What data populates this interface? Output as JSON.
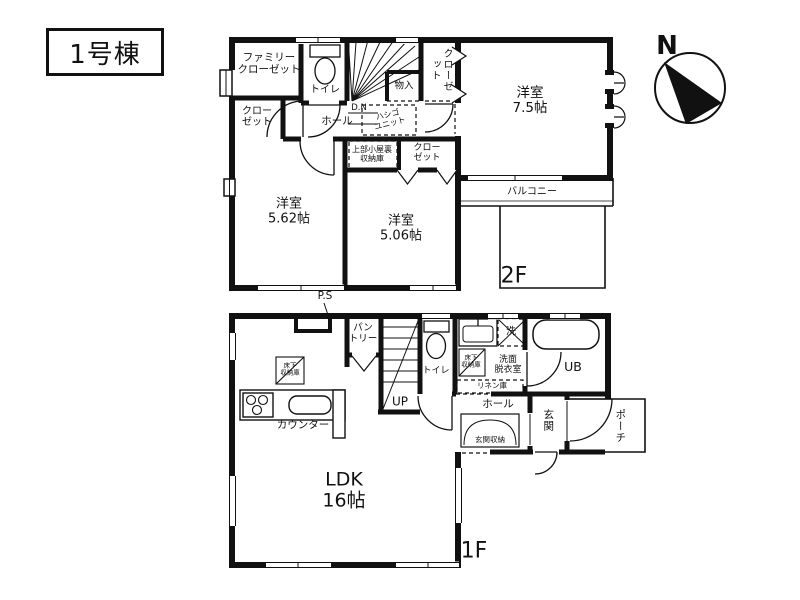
{
  "title": "1号棟",
  "compass": {
    "north": "N"
  },
  "f2": {
    "floor": "2F",
    "ps": "P.S",
    "family_closet": "ファミリー\nクローゼット",
    "closet_left": "クロー\nゼット",
    "toilet": "トイレ",
    "monoire": "物入",
    "closet_top": "クローゼット",
    "hall": "ホール",
    "dn": "D.N",
    "ladder": "ハシゴ\nユニット",
    "attic": "上部小屋裏\n収納庫",
    "closet_mid": "クロー\nゼット",
    "room_562": "洋室\n5.62帖",
    "room_506": "洋室\n5.06帖",
    "room_75": "洋室\n7.5帖",
    "balcony": "バルコニー"
  },
  "f1": {
    "floor": "1F",
    "pantry": "パン\nトリー",
    "up": "UP",
    "toilet": "トイレ",
    "underfloor_kitchen": "床下\n収納庫",
    "underfloor_wash": "床下\n収納庫",
    "washroom": "洗面\n脱衣室",
    "laundry": "洗",
    "linen": "リネン庫",
    "ub": "UB",
    "hall": "ホール",
    "entrance_storage": "玄関収納",
    "entrance": "玄関",
    "porch": "ポーチ",
    "counter": "カウンター",
    "ldk": "LDK\n16帖"
  }
}
